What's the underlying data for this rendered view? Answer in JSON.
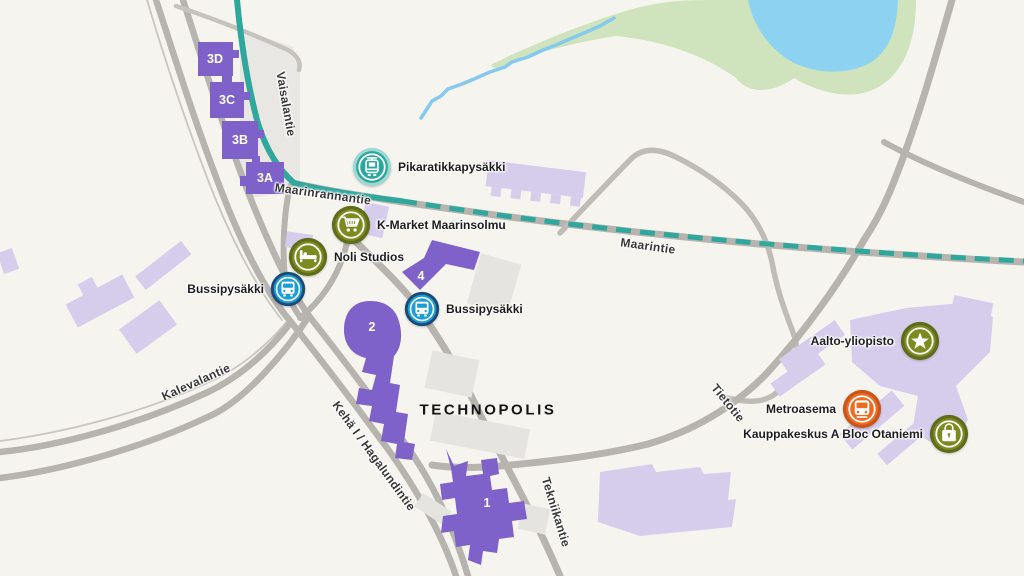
{
  "map": {
    "brand": {
      "label": "TECHNOPOLIS"
    },
    "buildings": {
      "b3d": "3D",
      "b3c": "3C",
      "b3b": "3B",
      "b3a": "3A",
      "b4": "4",
      "b2": "2",
      "b1": "1"
    },
    "streets": {
      "vaisalantie": "Vaisalantie",
      "maarinrannantie": "Maarinrannantie",
      "maarintie": "Maarintie",
      "kalevalantie": "Kalevalantie",
      "keha": "Kehä I / Hagalundintie",
      "tekniikantie": "Tekniikantie",
      "tietotie": "Tietotie"
    },
    "pois": [
      {
        "label": "Pikaratikkapysäkki",
        "icon": "tram-stop-icon",
        "color": "#2ba89e"
      },
      {
        "label": "K-Market Maarinsolmu",
        "icon": "shopping-cart-icon",
        "color": "#7b8b20"
      },
      {
        "label": "Noli Studios",
        "icon": "bed-icon",
        "color": "#7b8b20"
      },
      {
        "label": "Bussipysäkki",
        "icon": "bus-icon",
        "color": "#1a9cd8"
      },
      {
        "label": "Bussipysäkki",
        "icon": "bus-icon",
        "color": "#1a9cd8"
      },
      {
        "label": "Aalto-yliopisto",
        "icon": "star-icon",
        "color": "#7b8b20"
      },
      {
        "label": "Metroasema",
        "icon": "metro-icon",
        "color": "#ee6b21"
      },
      {
        "label": "Kauppakeskus A Bloc Otaniemi",
        "icon": "shopping-bag-icon",
        "color": "#7b8b20"
      }
    ],
    "colors": {
      "background": "#f6f4ef",
      "road": "#b7b4b0",
      "building_dark_purple": "#7e61c9",
      "building_light_purple": "#d6cdec",
      "building_gray": "#e6e4e0",
      "park_green": "#cfe3bd",
      "water_blue": "#8ed2f2",
      "tram_teal": "#2fa79c",
      "poi_olive": "#7b8b20",
      "poi_blue": "#1a9cd8",
      "poi_teal": "#2ba89e",
      "poi_orange": "#ee6b21"
    }
  }
}
